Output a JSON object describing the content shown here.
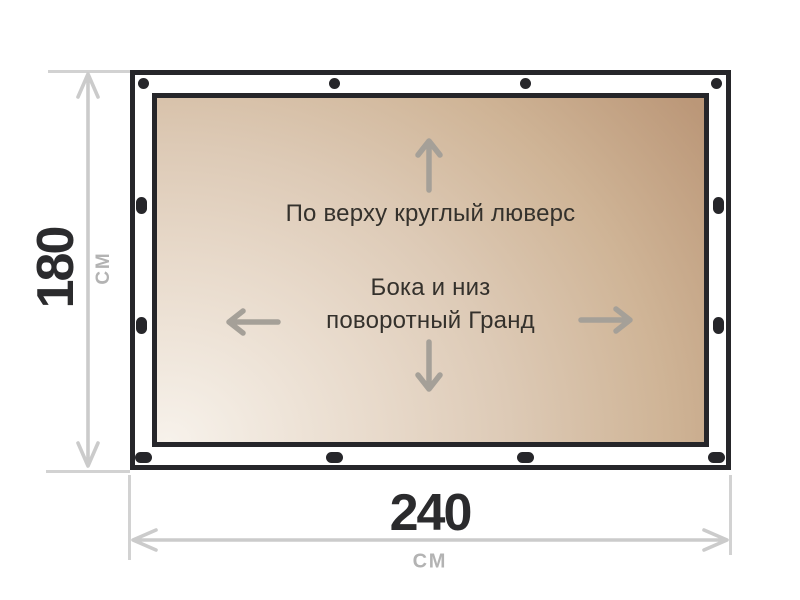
{
  "banner": {
    "top_note": "По верху круглый люверс",
    "middle_note_line1": "Бока и низ",
    "middle_note_line2": "поворотный Гранд"
  },
  "dimensions": {
    "height_value": "180",
    "height_unit": "СМ",
    "width_value": "240",
    "width_unit": "СМ"
  },
  "grommets": {
    "top_count": 4,
    "bottom_count": 4,
    "left_count": 4,
    "right_count": 4,
    "top_type": "round",
    "side_type": "vertical-oval",
    "bottom_type": "horizontal-oval"
  },
  "colors": {
    "frame": "#26262a",
    "grommet": "#26262a",
    "canvas_gradient_light": "#f7f2eb",
    "canvas_gradient_mid": "#ddcab6",
    "canvas_gradient_dark": "#bb9778",
    "note_text": "#34312c",
    "canvas_arrow": "#a5a098",
    "dimension_number": "#2b2b2d",
    "dimension_unit": "#b3b3b3",
    "dimension_line": "#cbcbcb"
  }
}
